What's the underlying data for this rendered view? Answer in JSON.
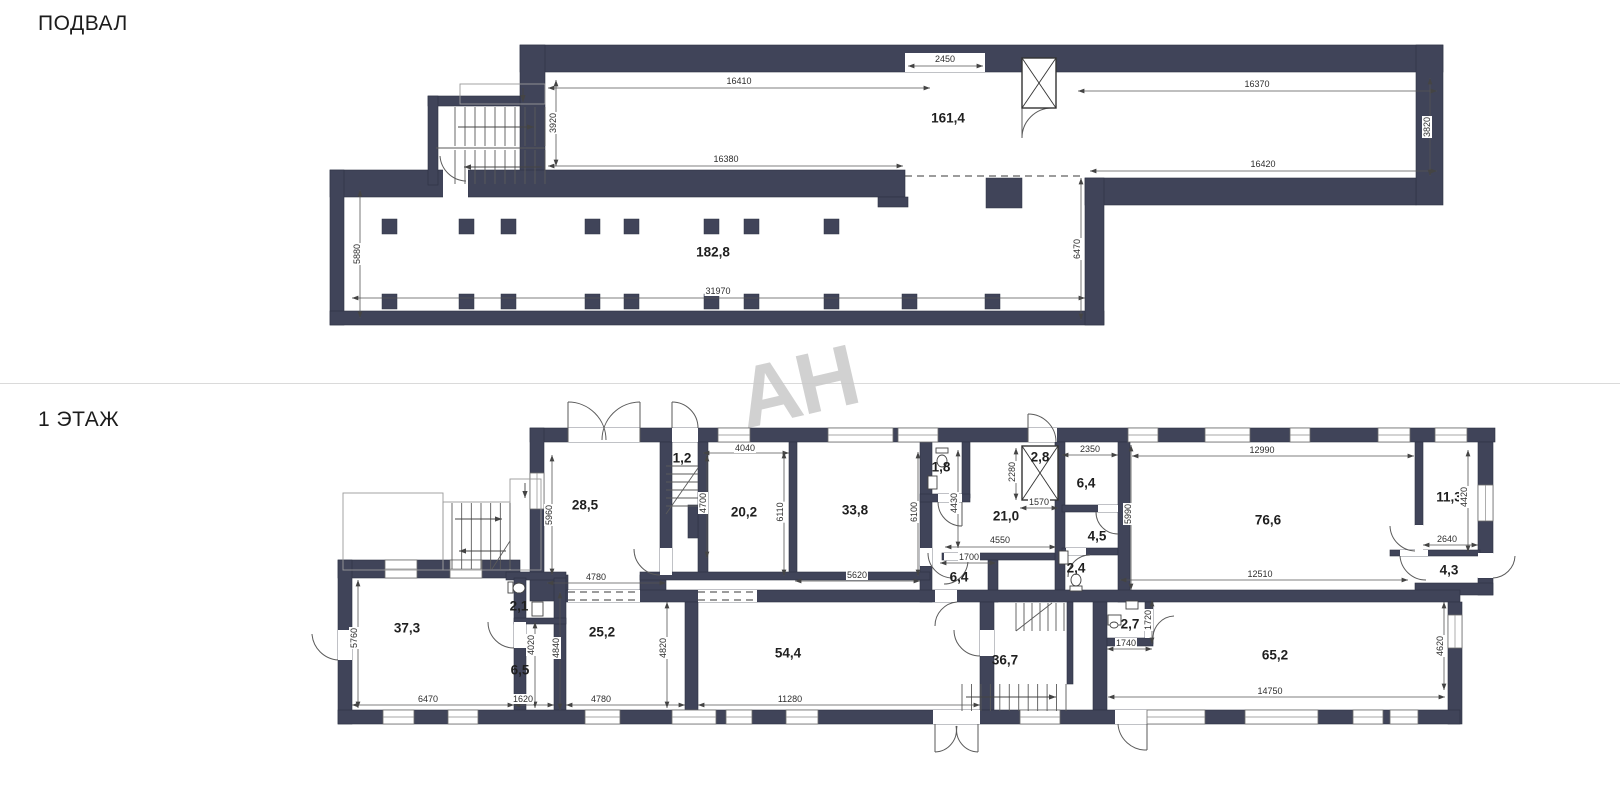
{
  "page": {
    "basement_title": "ПОДВАЛ",
    "floor1_title": "1 ЭТАЖ",
    "watermark": "АН",
    "wall_color": "#404459",
    "line_color": "#5a5a5a"
  },
  "basement": {
    "rooms": [
      {
        "text": "161,4",
        "x": 948,
        "y": 118
      },
      {
        "text": "182,8",
        "x": 713,
        "y": 252
      }
    ],
    "dims": [
      {
        "text": "16410",
        "x": 739,
        "y": 81,
        "x1": 548,
        "y1": 88,
        "x2": 930,
        "y2": 88
      },
      {
        "text": "2450",
        "x": 945,
        "y": 59,
        "x1": 908,
        "y1": 66,
        "x2": 983,
        "y2": 66
      },
      {
        "text": "16380",
        "x": 726,
        "y": 159,
        "x1": 548,
        "y1": 166,
        "x2": 903,
        "y2": 166
      },
      {
        "text": "3920",
        "x": 553,
        "y": 123,
        "rot": -90,
        "x1": 556,
        "y1": 80,
        "x2": 556,
        "y2": 166
      },
      {
        "text": "16370",
        "x": 1257,
        "y": 84,
        "x1": 1078,
        "y1": 91,
        "x2": 1437,
        "y2": 91
      },
      {
        "text": "16420",
        "x": 1263,
        "y": 164,
        "x1": 1090,
        "y1": 171,
        "x2": 1437,
        "y2": 171
      },
      {
        "text": "3820",
        "x": 1427,
        "y": 127,
        "rot": -90,
        "x1": 1430,
        "y1": 78,
        "x2": 1430,
        "y2": 176
      },
      {
        "text": "5880",
        "x": 357,
        "y": 254,
        "rot": -90,
        "x1": 360,
        "y1": 190,
        "x2": 360,
        "y2": 318
      },
      {
        "text": "31970",
        "x": 718,
        "y": 291,
        "x1": 352,
        "y1": 298,
        "x2": 1085,
        "y2": 298
      },
      {
        "text": "6470",
        "x": 1077,
        "y": 249,
        "rot": -90,
        "x1": 1081,
        "y1": 178,
        "x2": 1081,
        "y2": 320
      }
    ]
  },
  "floor1": {
    "rooms": [
      {
        "text": "28,5",
        "x": 585,
        "y": 505
      },
      {
        "text": "1,2",
        "x": 682,
        "y": 458
      },
      {
        "text": "20,2",
        "x": 744,
        "y": 512
      },
      {
        "text": "33,8",
        "x": 855,
        "y": 510
      },
      {
        "text": "1,8",
        "x": 941,
        "y": 467
      },
      {
        "text": "2,8",
        "x": 1040,
        "y": 457
      },
      {
        "text": "21,0",
        "x": 1006,
        "y": 516
      },
      {
        "text": "6,4",
        "x": 1086,
        "y": 483
      },
      {
        "text": "4,5",
        "x": 1097,
        "y": 536
      },
      {
        "text": "2,4",
        "x": 1076,
        "y": 568
      },
      {
        "text": "6,4",
        "x": 959,
        "y": 577
      },
      {
        "text": "76,6",
        "x": 1268,
        "y": 520
      },
      {
        "text": "11,3",
        "x": 1449,
        "y": 497
      },
      {
        "text": "4,3",
        "x": 1449,
        "y": 570
      },
      {
        "text": "37,3",
        "x": 407,
        "y": 628
      },
      {
        "text": "2,1",
        "x": 519,
        "y": 606
      },
      {
        "text": "6,5",
        "x": 520,
        "y": 670
      },
      {
        "text": "25,2",
        "x": 602,
        "y": 632
      },
      {
        "text": "54,4",
        "x": 788,
        "y": 653
      },
      {
        "text": "36,7",
        "x": 1005,
        "y": 660
      },
      {
        "text": "2,7",
        "x": 1130,
        "y": 624
      },
      {
        "text": "65,2",
        "x": 1275,
        "y": 655
      }
    ],
    "dims": [
      {
        "text": "5960",
        "x": 549,
        "y": 515,
        "rot": -90,
        "x1": 552,
        "y1": 455,
        "x2": 552,
        "y2": 575
      },
      {
        "text": "4780",
        "x": 596,
        "y": 577,
        "x1": 547,
        "y1": 583,
        "x2": 666,
        "y2": 583
      },
      {
        "text": "4040",
        "x": 745,
        "y": 448,
        "x1": 703,
        "y1": 453,
        "x2": 789,
        "y2": 453
      },
      {
        "text": "4700",
        "x": 703,
        "y": 503,
        "rot": -90,
        "x1": 707,
        "y1": 455,
        "x2": 707,
        "y2": 558
      },
      {
        "text": "6110",
        "x": 780,
        "y": 512,
        "rot": -90,
        "x1": 784,
        "y1": 452,
        "x2": 784,
        "y2": 576
      },
      {
        "text": "5620",
        "x": 857,
        "y": 575,
        "x1": 795,
        "y1": 581,
        "x2": 920,
        "y2": 581
      },
      {
        "text": "6100",
        "x": 914,
        "y": 512,
        "rot": -90,
        "x1": 918,
        "y1": 452,
        "x2": 918,
        "y2": 576
      },
      {
        "text": "4430",
        "x": 954,
        "y": 503,
        "rot": -90,
        "x1": 958,
        "y1": 450,
        "x2": 958,
        "y2": 548
      },
      {
        "text": "2280",
        "x": 1012,
        "y": 472,
        "rot": -90,
        "x1": 1016,
        "y1": 448,
        "x2": 1016,
        "y2": 500
      },
      {
        "text": "1570",
        "x": 1039,
        "y": 502,
        "x1": 1020,
        "y1": 508,
        "x2": 1058,
        "y2": 508
      },
      {
        "text": "2350",
        "x": 1090,
        "y": 449,
        "x1": 1062,
        "y1": 455,
        "x2": 1118,
        "y2": 455
      },
      {
        "text": "5990",
        "x": 1128,
        "y": 514,
        "rot": -90,
        "x1": 1131,
        "y1": 445,
        "x2": 1131,
        "y2": 590
      },
      {
        "text": "4550",
        "x": 1000,
        "y": 540,
        "x1": 945,
        "y1": 547,
        "x2": 1056,
        "y2": 547
      },
      {
        "text": "1700",
        "x": 969,
        "y": 557,
        "x1": 940,
        "y1": 563,
        "x2": 996,
        "y2": 563
      },
      {
        "text": "12990",
        "x": 1262,
        "y": 450,
        "x1": 1132,
        "y1": 456,
        "x2": 1414,
        "y2": 456
      },
      {
        "text": "12510",
        "x": 1260,
        "y": 574,
        "x1": 1120,
        "y1": 580,
        "x2": 1408,
        "y2": 580
      },
      {
        "text": "4420",
        "x": 1464,
        "y": 497,
        "rot": -90,
        "x1": 1468,
        "y1": 450,
        "x2": 1468,
        "y2": 552
      },
      {
        "text": "2640",
        "x": 1447,
        "y": 539,
        "x1": 1423,
        "y1": 545,
        "x2": 1478,
        "y2": 545
      },
      {
        "text": "5760",
        "x": 354,
        "y": 638,
        "rot": -90,
        "x1": 358,
        "y1": 580,
        "x2": 358,
        "y2": 708
      },
      {
        "text": "6470",
        "x": 428,
        "y": 699,
        "x1": 352,
        "y1": 705,
        "x2": 514,
        "y2": 705
      },
      {
        "text": "1620",
        "x": 523,
        "y": 699,
        "x1": 514,
        "y1": 705,
        "x2": 554,
        "y2": 705
      },
      {
        "text": "4780",
        "x": 601,
        "y": 699,
        "x1": 566,
        "y1": 705,
        "x2": 685,
        "y2": 705
      },
      {
        "text": "4020",
        "x": 531,
        "y": 645,
        "rot": -90,
        "x1": 535,
        "y1": 622,
        "x2": 535,
        "y2": 708
      },
      {
        "text": "4840",
        "x": 556,
        "y": 648,
        "rot": -90,
        "x1": 560,
        "y1": 592,
        "x2": 560,
        "y2": 710
      },
      {
        "text": "4820",
        "x": 663,
        "y": 648,
        "rot": -90,
        "x1": 667,
        "y1": 602,
        "x2": 667,
        "y2": 708
      },
      {
        "text": "11280",
        "x": 790,
        "y": 699,
        "x1": 698,
        "y1": 705,
        "x2": 980,
        "y2": 705
      },
      {
        "text": "1720",
        "x": 1148,
        "y": 620,
        "rot": -90,
        "x1": 1152,
        "y1": 600,
        "x2": 1152,
        "y2": 644
      },
      {
        "text": "1740",
        "x": 1126,
        "y": 643,
        "x1": 1107,
        "y1": 649,
        "x2": 1152,
        "y2": 649
      },
      {
        "text": "14750",
        "x": 1270,
        "y": 691,
        "x1": 1108,
        "y1": 697,
        "x2": 1445,
        "y2": 697
      },
      {
        "text": "4620",
        "x": 1440,
        "y": 646,
        "rot": -90,
        "x1": 1444,
        "y1": 602,
        "x2": 1444,
        "y2": 690
      }
    ]
  }
}
